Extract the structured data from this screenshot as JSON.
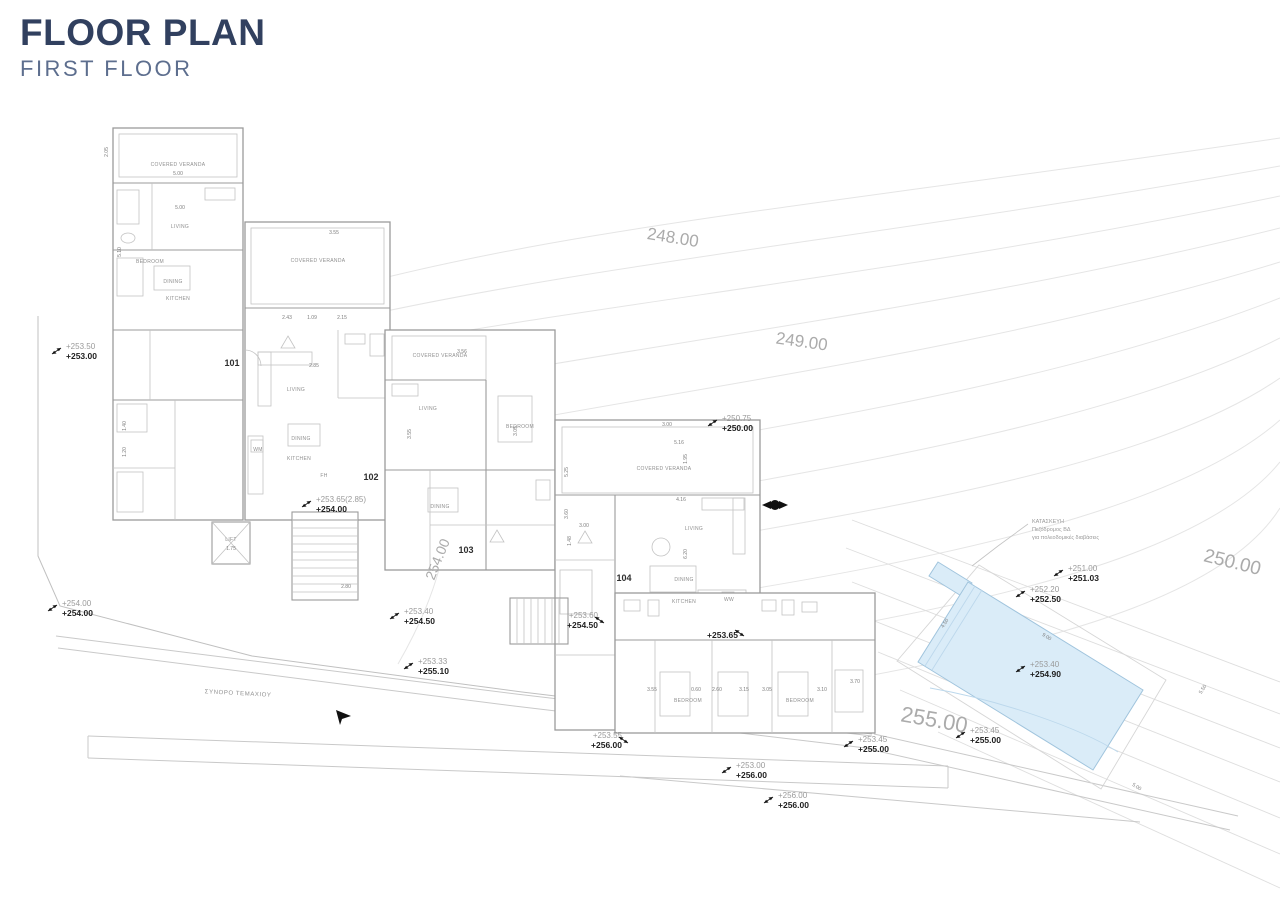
{
  "header": {
    "title": "FLOOR PLAN",
    "subtitle": "FIRST FLOOR"
  },
  "colors": {
    "title": "#31405f",
    "subtitle": "#5d6e8e",
    "contour_line": "#e5e5e5",
    "contour_label": "#ababab",
    "wall": "#9b9b9b",
    "pool_fill": "#daecf8",
    "pool_stroke": "#a0c4dd",
    "marker_dark": "#1f1f1f",
    "marker_light": "#9a9a9a"
  },
  "contour_labels": [
    {
      "text": "248.00",
      "x": 672,
      "y": 243,
      "rot": 9,
      "size": 17
    },
    {
      "text": "249.00",
      "x": 801,
      "y": 347,
      "rot": 8,
      "size": 17
    },
    {
      "text": "250.00",
      "x": 1231,
      "y": 568,
      "rot": 14,
      "size": 19
    },
    {
      "text": "255.00",
      "x": 933,
      "y": 727,
      "rot": 10,
      "size": 22
    },
    {
      "text": "254.00",
      "x": 442,
      "y": 561,
      "rot": -68,
      "size": 14
    }
  ],
  "unit_labels": [
    {
      "text": "101",
      "x": 232,
      "y": 366
    },
    {
      "text": "102",
      "x": 371,
      "y": 480
    },
    {
      "text": "103",
      "x": 466,
      "y": 553
    },
    {
      "text": "104",
      "x": 624,
      "y": 581
    }
  ],
  "room_labels": [
    {
      "text": "COVERED VERANDA",
      "x": 178,
      "y": 166
    },
    {
      "text": "COVERED VERANDA",
      "x": 318,
      "y": 262
    },
    {
      "text": "COVERED VERANDA",
      "x": 440,
      "y": 357
    },
    {
      "text": "COVERED VERANDA",
      "x": 664,
      "y": 470
    },
    {
      "text": "LIVING",
      "x": 180,
      "y": 228
    },
    {
      "text": "LIVING",
      "x": 296,
      "y": 391
    },
    {
      "text": "LIVING",
      "x": 428,
      "y": 410
    },
    {
      "text": "LIVING",
      "x": 694,
      "y": 530
    },
    {
      "text": "DINING",
      "x": 173,
      "y": 283
    },
    {
      "text": "DINING",
      "x": 301,
      "y": 440
    },
    {
      "text": "DINING",
      "x": 440,
      "y": 508
    },
    {
      "text": "DINING",
      "x": 684,
      "y": 581
    },
    {
      "text": "KITCHEN",
      "x": 178,
      "y": 300
    },
    {
      "text": "KITCHEN",
      "x": 299,
      "y": 460
    },
    {
      "text": "KITCHEN",
      "x": 684,
      "y": 603
    },
    {
      "text": "BEDROOM",
      "x": 150,
      "y": 263
    },
    {
      "text": "BEDROOM",
      "x": 520,
      "y": 428
    },
    {
      "text": "BEDROOM",
      "x": 688,
      "y": 702
    },
    {
      "text": "BEDROOM",
      "x": 800,
      "y": 702
    },
    {
      "text": "WM",
      "x": 258,
      "y": 451
    },
    {
      "text": "FH",
      "x": 324,
      "y": 477
    },
    {
      "text": "WW",
      "x": 729,
      "y": 601
    },
    {
      "text": "LIFT",
      "x": 231,
      "y": 541
    }
  ],
  "dimension_labels": [
    {
      "text": "2.05",
      "x": 108,
      "y": 152,
      "rot": -90
    },
    {
      "text": "5.00",
      "x": 178,
      "y": 175,
      "rot": 0
    },
    {
      "text": "5.00",
      "x": 180,
      "y": 209,
      "rot": 0
    },
    {
      "text": "5.10",
      "x": 121,
      "y": 252,
      "rot": -90
    },
    {
      "text": "3.55",
      "x": 334,
      "y": 234,
      "rot": 0
    },
    {
      "text": "2.43",
      "x": 287,
      "y": 319,
      "rot": 0
    },
    {
      "text": "1.09",
      "x": 312,
      "y": 319,
      "rot": 0
    },
    {
      "text": "2.15",
      "x": 342,
      "y": 319,
      "rot": 0
    },
    {
      "text": "2.85",
      "x": 314,
      "y": 367,
      "rot": 0
    },
    {
      "text": "3.56",
      "x": 462,
      "y": 353,
      "rot": 0
    },
    {
      "text": "3.55",
      "x": 411,
      "y": 434,
      "rot": -90
    },
    {
      "text": "3.05",
      "x": 517,
      "y": 431,
      "rot": -90
    },
    {
      "text": "5.25",
      "x": 568,
      "y": 472,
      "rot": -90
    },
    {
      "text": "3.60",
      "x": 568,
      "y": 514,
      "rot": -90
    },
    {
      "text": "3.00",
      "x": 584,
      "y": 527,
      "rot": 0
    },
    {
      "text": "1.48",
      "x": 571,
      "y": 541,
      "rot": -90
    },
    {
      "text": "3.00",
      "x": 667,
      "y": 426,
      "rot": 0
    },
    {
      "text": "5.16",
      "x": 679,
      "y": 444,
      "rot": 0
    },
    {
      "text": "1.95",
      "x": 687,
      "y": 459,
      "rot": -90
    },
    {
      "text": "4.16",
      "x": 681,
      "y": 501,
      "rot": 0
    },
    {
      "text": "6.20",
      "x": 687,
      "y": 554,
      "rot": -90
    },
    {
      "text": "2.80",
      "x": 346,
      "y": 588,
      "rot": 0
    },
    {
      "text": "1.40",
      "x": 126,
      "y": 426,
      "rot": -90
    },
    {
      "text": "1.20",
      "x": 126,
      "y": 452,
      "rot": -90
    },
    {
      "text": "1.75",
      "x": 231,
      "y": 550,
      "rot": 0
    },
    {
      "text": "3.55",
      "x": 652,
      "y": 691,
      "rot": 0
    },
    {
      "text": "0.60",
      "x": 696,
      "y": 691,
      "rot": 0
    },
    {
      "text": "2.60",
      "x": 717,
      "y": 691,
      "rot": 0
    },
    {
      "text": "3.15",
      "x": 744,
      "y": 691,
      "rot": 0
    },
    {
      "text": "3.05",
      "x": 767,
      "y": 691,
      "rot": 0
    },
    {
      "text": "3.10",
      "x": 822,
      "y": 691,
      "rot": 0
    },
    {
      "text": "3.70",
      "x": 855,
      "y": 683,
      "rot": 0
    },
    {
      "text": "9.00",
      "x": 1046,
      "y": 638,
      "rot": 31
    },
    {
      "text": "4.50",
      "x": 946,
      "y": 624,
      "rot": -58
    },
    {
      "text": "5.00",
      "x": 1136,
      "y": 788,
      "rot": 31
    },
    {
      "text": "5.50",
      "x": 1204,
      "y": 690,
      "rot": -58
    }
  ],
  "elevation_markers": [
    {
      "top": "+253.50",
      "bottom": "+253.00",
      "x": 66,
      "y": 349,
      "flip": false
    },
    {
      "top": "+254.00",
      "bottom": "+254.00",
      "x": 62,
      "y": 606,
      "flip": false
    },
    {
      "top": "+253.65(2.85)",
      "bottom": "+254.00",
      "x": 316,
      "y": 502,
      "flip": false
    },
    {
      "top": "+253.40",
      "bottom": "+254.50",
      "x": 404,
      "y": 614,
      "flip": false
    },
    {
      "top": "+253.60",
      "bottom": "+254.50",
      "x": 598,
      "y": 618,
      "flip": true
    },
    {
      "top": "+253.65",
      "bottom": "",
      "x": 738,
      "y": 638,
      "flip": true
    },
    {
      "top": "+250.75",
      "bottom": "+250.00",
      "x": 722,
      "y": 421,
      "flip": false
    },
    {
      "top": "+253.33",
      "bottom": "+255.10",
      "x": 418,
      "y": 664,
      "flip": false
    },
    {
      "top": "+253.55",
      "bottom": "+256.00",
      "x": 622,
      "y": 738,
      "flip": true
    },
    {
      "top": "+253.45",
      "bottom": "+255.00",
      "x": 858,
      "y": 742,
      "flip": false
    },
    {
      "top": "+253.45",
      "bottom": "+255.00",
      "x": 970,
      "y": 733,
      "flip": false
    },
    {
      "top": "+253.00",
      "bottom": "+256.00",
      "x": 736,
      "y": 768,
      "flip": false
    },
    {
      "top": "+256.00",
      "bottom": "+256.00",
      "x": 778,
      "y": 798,
      "flip": false
    },
    {
      "top": "+251.00",
      "bottom": "+251.03",
      "x": 1068,
      "y": 571,
      "flip": false
    },
    {
      "top": "+252.20",
      "bottom": "+252.50",
      "x": 1030,
      "y": 592,
      "flip": false
    },
    {
      "top": "+253.40",
      "bottom": "+254.90",
      "x": 1030,
      "y": 667,
      "flip": false
    }
  ],
  "notes": {
    "boundary_label": {
      "text": "ΣΥΝΟΡΟ ΤΕΜΑΧΙΟΥ",
      "x": 238,
      "y": 695,
      "rot": 3
    },
    "pool_note": {
      "x": 1032,
      "y": 523,
      "lines": [
        "ΚΑΤΑΣΚΕΥΗ",
        "Πεζόδρομος ΒΔ",
        "για πολεοδομικές διαβάσεις"
      ]
    }
  }
}
